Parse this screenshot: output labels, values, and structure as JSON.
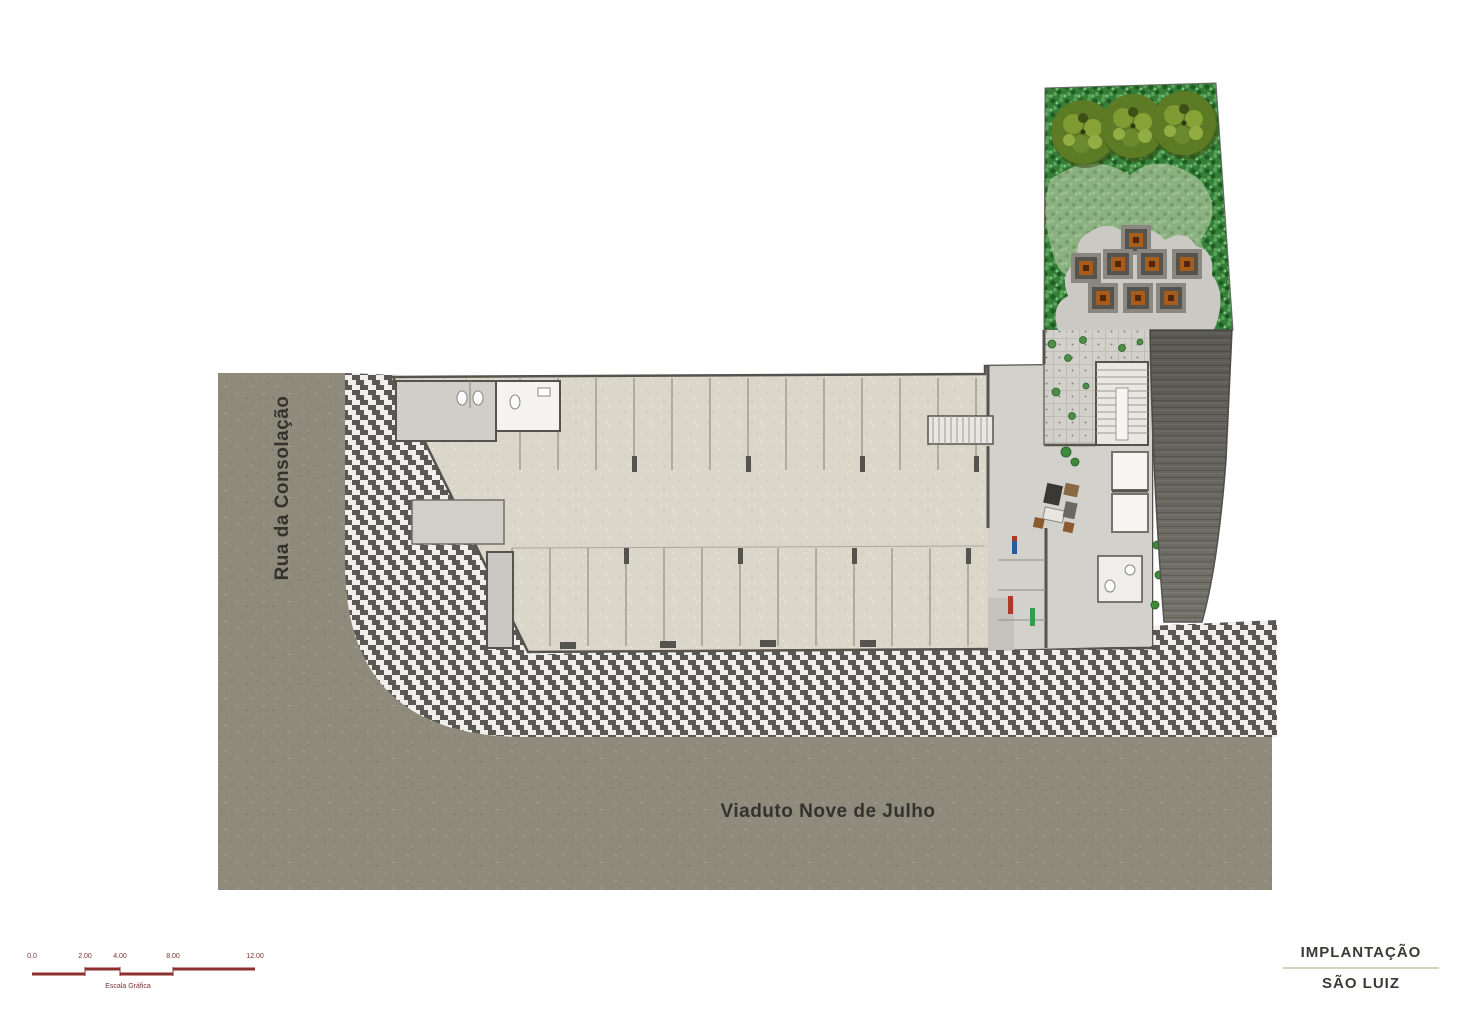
{
  "plan": {
    "street_left_label": "Rua da Consolação",
    "street_bottom_label": "Viaduto Nove de Julho"
  },
  "title_block": {
    "title": "IMPLANTAÇÃO",
    "subtitle": "SÃO LUIZ"
  },
  "scale_bar": {
    "marks": [
      "0.0",
      "2.00",
      "4.00",
      "8.00",
      "12.00"
    ],
    "caption": "Escala Gráfica"
  },
  "features": {
    "garden": "landscaped garden with trees and planters",
    "ramp": "vehicle ramp",
    "parking": "parking hall with stalls",
    "sidewalk": "mosaic pavement"
  },
  "colors": {
    "street": "#8f8b7c",
    "sidewalk_dark": "#5a5854",
    "building_floor": "#dad7ca",
    "wall": "#55534d",
    "garden_green": "#357f38",
    "tree_olive": "#5d7a25",
    "ramp_gray": "#73726b",
    "planter_center": "#a85c1c",
    "scale_red": "#8b2f2f",
    "title_rule": "#d9d0c2"
  }
}
